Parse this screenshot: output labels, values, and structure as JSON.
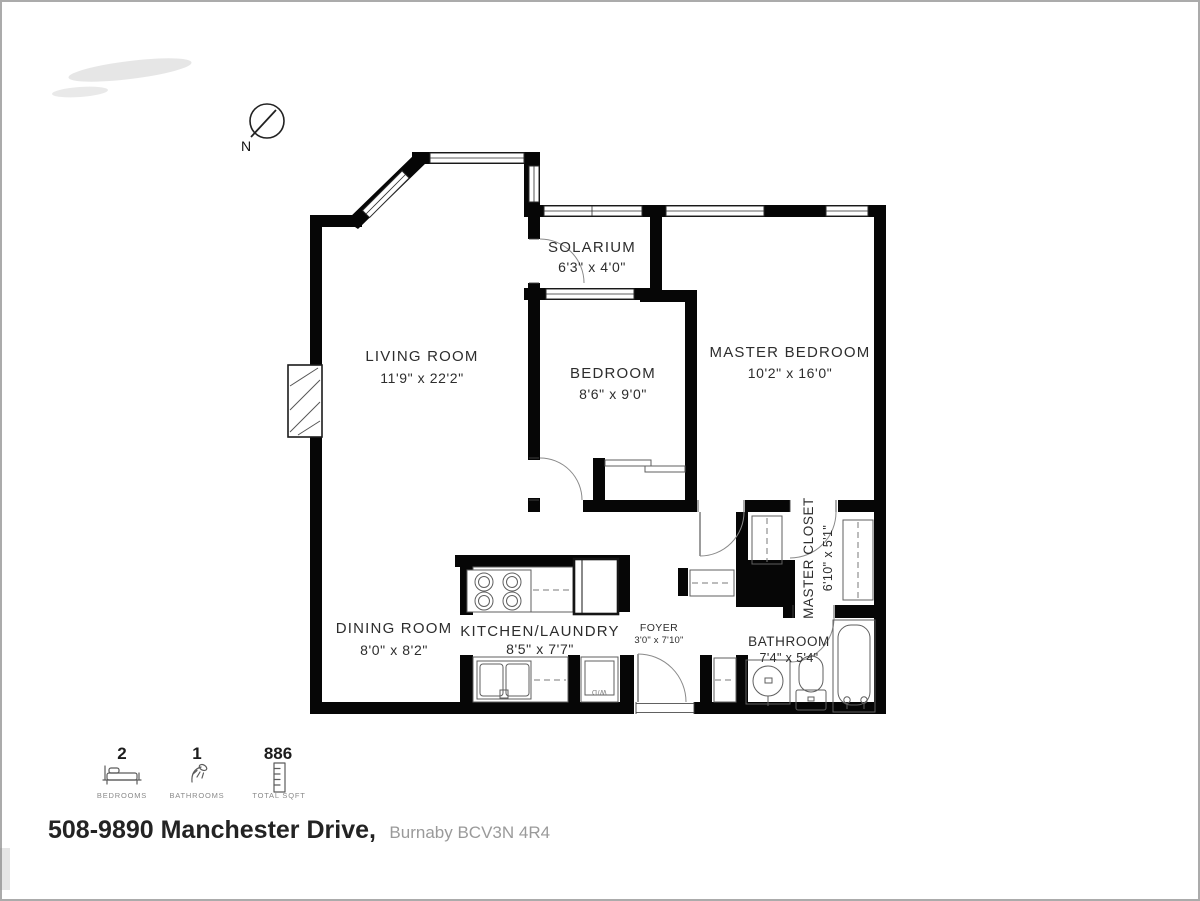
{
  "compass": {
    "label": "N"
  },
  "rooms": [
    {
      "id": "solarium",
      "name": "SOLARIUM",
      "dims": "6'3\" x 4'0\""
    },
    {
      "id": "living-room",
      "name": "LIVING ROOM",
      "dims": "11'9\" x 22'2\""
    },
    {
      "id": "bedroom",
      "name": "BEDROOM",
      "dims": "8'6\" x 9'0\""
    },
    {
      "id": "master-bedroom",
      "name": "MASTER BEDROOM",
      "dims": "10'2\" x 16'0\""
    },
    {
      "id": "master-closet",
      "name": "MASTER CLOSET",
      "dims": "6'10\" x 5'1\""
    },
    {
      "id": "dining-room",
      "name": "DINING ROOM",
      "dims": "8'0\" x 8'2\""
    },
    {
      "id": "kitchen-laundry",
      "name": "KITCHEN/LAUNDRY",
      "dims": "8'5\" x 7'7\""
    },
    {
      "id": "foyer",
      "name": "FOYER",
      "dims": "3'0\" x 7'10\""
    },
    {
      "id": "bathroom",
      "name": "BATHROOM",
      "dims": "7'4\" x 5'4\""
    }
  ],
  "appliances": {
    "washer_dryer_label": "W/D"
  },
  "legend": {
    "items": [
      {
        "value": "2",
        "label": "BEDROOMS",
        "icon": "bed-icon"
      },
      {
        "value": "1",
        "label": "BATHROOMS",
        "icon": "shower-icon"
      },
      {
        "value": "886",
        "label": "TOTAL SQFT",
        "icon": "ruler-icon"
      }
    ]
  },
  "address": {
    "main": "508-9890 Manchester Drive,",
    "city_postal": "Burnaby BCV3N 4R4"
  },
  "colors": {
    "wall": "#060606",
    "fixture_line": "#5f5f5f",
    "label_text": "#2d2d2d",
    "muted_text": "#9a9a9a"
  }
}
